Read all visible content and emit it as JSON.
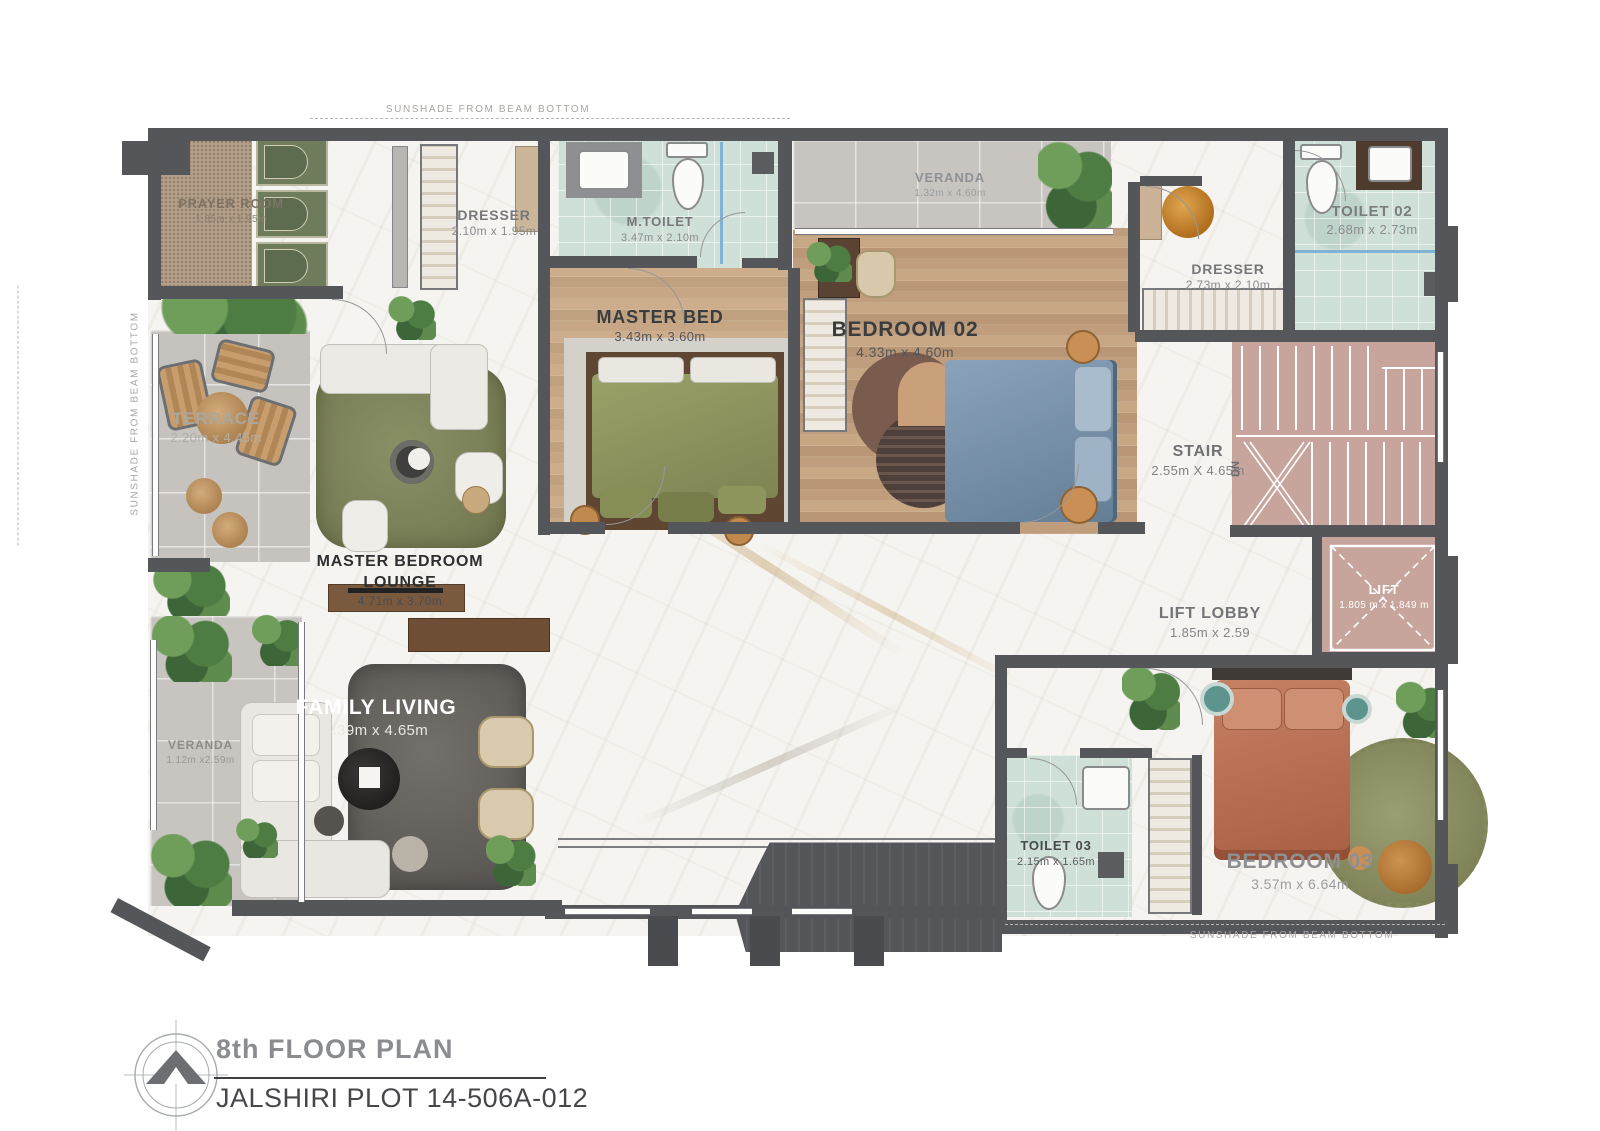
{
  "title_block": {
    "title": "8th FLOOR PLAN",
    "subtitle": "JALSHIRI PLOT 14-506A-012"
  },
  "annotations": {
    "sunshade": "SUNSHADE FROM BEAM BOTTOM",
    "stair_direction": "DN"
  },
  "rooms": {
    "prayer_room": {
      "name": "PRAYER ROOM",
      "dims": "1.85m x 1.95m"
    },
    "dresser_master": {
      "name": "DRESSER",
      "dims": "2.10m x 1.95m"
    },
    "m_toilet": {
      "name": "M.TOILET",
      "dims": "3.47m x 2.10m"
    },
    "master_bed": {
      "name": "MASTER BED",
      "dims": "3.43m x 3.60m"
    },
    "bedroom_02": {
      "name": "BEDROOM 02",
      "dims": "4.33m x 4.60m"
    },
    "veranda_top": {
      "name": "VERANDA",
      "dims": "1.32m x 4.60m"
    },
    "dresser_02": {
      "name": "DRESSER",
      "dims": "2.73m x 2.10m"
    },
    "toilet_02": {
      "name": "TOILET 02",
      "dims": "2.68m x 2.73m"
    },
    "terrace": {
      "name": "TERRACE",
      "dims": "2.20m x 4.45m"
    },
    "master_bedroom_lounge": {
      "name": "MASTER BEDROOM LOUNGE",
      "dims": "4.71m x 3.70m"
    },
    "stair": {
      "name": "STAIR",
      "dims": "2.55m X 4.65m"
    },
    "lift_lobby": {
      "name": "LIFT LOBBY",
      "dims": "1.85m x 2.59"
    },
    "lift": {
      "name": "LIFT",
      "dims": "1.805 m x 1.849 m"
    },
    "family_living": {
      "name": "FAMILY LIVING",
      "dims": "4.39m x 4.65m"
    },
    "veranda_left": {
      "name": "VERANDA",
      "dims": "1.12m x2.59m"
    },
    "toilet_03": {
      "name": "TOILET 03",
      "dims": "2.15m x 1.65m"
    },
    "bedroom_03": {
      "name": "BEDROOM 03",
      "dims": "3.57m x 6.64m"
    }
  },
  "colors": {
    "wall": "#55565a",
    "stair_pink": "#c7a59d",
    "rug_green": "#7f855f",
    "rug_dark": "#6b6661",
    "bedding_olive": "#8f955f",
    "bedding_blue": "#7c95ac",
    "bedding_rust": "#bf7a5a",
    "tile_green": "#cfe0d8"
  }
}
